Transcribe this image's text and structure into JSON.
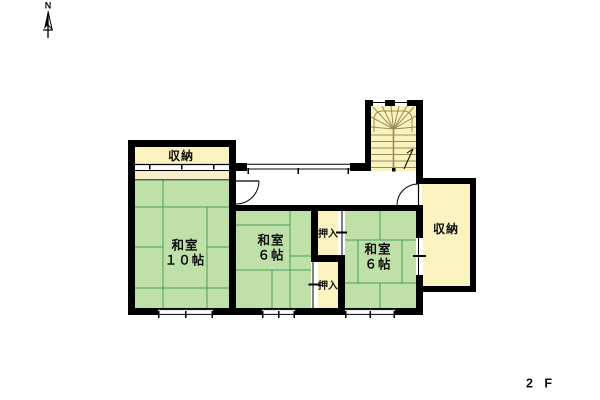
{
  "compass": {
    "label": "N"
  },
  "floor": {
    "label": "2 F"
  },
  "rooms": {
    "storage_tl": {
      "name": "収納"
    },
    "washitsu_10": {
      "name": "和室",
      "size": "１０帖"
    },
    "washitsu_6_center": {
      "name": "和室",
      "size": "６帖"
    },
    "oshiire_top": {
      "name": "押入"
    },
    "oshiire_bottom": {
      "name": "押入"
    },
    "washitsu_6_right": {
      "name": "和室",
      "size": "６帖"
    },
    "storage_right": {
      "name": "収納"
    }
  },
  "colors": {
    "wall": "#000000",
    "tatami": "#bfe0a8",
    "tatami_line": "#44a258",
    "closet": "#faf3c0",
    "closet_band": "#f6efca",
    "stair_line": "#9a8c52",
    "background": "#ffffff"
  }
}
